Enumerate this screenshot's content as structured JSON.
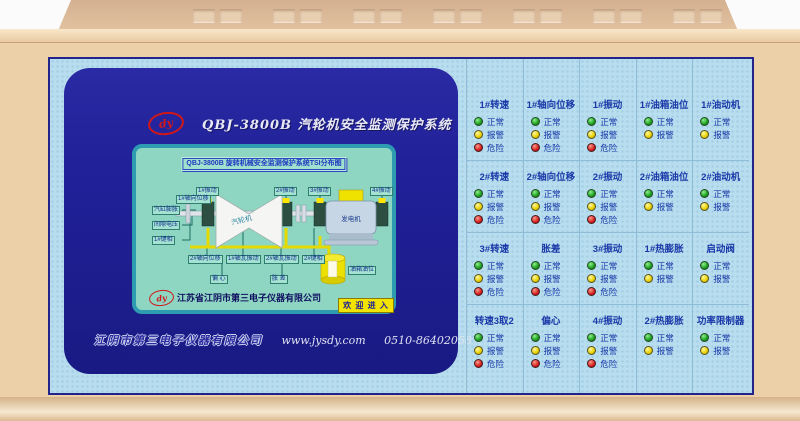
{
  "header": {
    "logo": "dy",
    "title": "QBJ-3800B  汽轮机安全监测保护系统"
  },
  "mimic": {
    "title_bar": "QBJ-3800B 旋转机械安全监测保护系统TSI分布图",
    "top_sensors": [
      "1#振动",
      "2#振动",
      "3#振动",
      "4#振动"
    ],
    "left_sensors": [
      "1#轴向位移",
      "汽缸膨胀",
      "间隙电压",
      "1#键相"
    ],
    "bottom_sensors": [
      "2#轴向位移",
      "1#轴瓦振动",
      "2#轴瓦振动",
      "2#键相"
    ],
    "float_labels": [
      "偏 心",
      "胀 差"
    ],
    "turbine": "汽轮机",
    "generator": "发电机",
    "tank_label": "油箱油位",
    "company": "江苏省江阴市第三电子仪器有限公司",
    "enter_button": "欢 迎 进 入"
  },
  "footer": {
    "company": "江阴市第三电子仪器有限公司",
    "url": "www.jysdy.com",
    "phone": "0510-86402058"
  },
  "indicators": {
    "light_defs": {
      "normal": {
        "label": "正常"
      },
      "alarm": {
        "label": "报警"
      },
      "danger": {
        "label": "危险"
      }
    },
    "cells": [
      {
        "title": "1#转速",
        "lights": [
          "normal",
          "alarm",
          "danger"
        ]
      },
      {
        "title": "1#轴向位移",
        "lights": [
          "normal",
          "alarm",
          "danger"
        ]
      },
      {
        "title": "1#振动",
        "lights": [
          "normal",
          "alarm",
          "danger"
        ]
      },
      {
        "title": "1#油箱油位",
        "lights": [
          "normal",
          "alarm"
        ]
      },
      {
        "title": "1#油动机",
        "lights": [
          "normal",
          "alarm"
        ]
      },
      {
        "title": "2#转速",
        "lights": [
          "normal",
          "alarm",
          "danger"
        ]
      },
      {
        "title": "2#轴向位移",
        "lights": [
          "normal",
          "alarm",
          "danger"
        ]
      },
      {
        "title": "2#振动",
        "lights": [
          "normal",
          "alarm",
          "danger"
        ]
      },
      {
        "title": "2#油箱油位",
        "lights": [
          "normal",
          "alarm"
        ]
      },
      {
        "title": "2#油动机",
        "lights": [
          "normal",
          "alarm"
        ]
      },
      {
        "title": "3#转速",
        "lights": [
          "normal",
          "alarm",
          "danger"
        ]
      },
      {
        "title": "胀差",
        "lights": [
          "normal",
          "alarm",
          "danger"
        ]
      },
      {
        "title": "3#振动",
        "lights": [
          "normal",
          "alarm",
          "danger"
        ]
      },
      {
        "title": "1#热膨胀",
        "lights": [
          "normal",
          "alarm"
        ]
      },
      {
        "title": "启动阀",
        "lights": [
          "normal",
          "alarm"
        ]
      },
      {
        "title": "转速3取2",
        "lights": [
          "normal",
          "alarm",
          "danger"
        ]
      },
      {
        "title": "偏心",
        "lights": [
          "normal",
          "alarm",
          "danger"
        ]
      },
      {
        "title": "4#振动",
        "lights": [
          "normal",
          "alarm",
          "danger"
        ]
      },
      {
        "title": "2#热膨胀",
        "lights": [
          "normal",
          "alarm"
        ]
      },
      {
        "title": "功率限制器",
        "lights": [
          "normal",
          "alarm"
        ]
      }
    ]
  },
  "colors": {
    "beige": "#ecd0a8",
    "beige_dark": "#d3b191",
    "panel_blue": "#b7ddee",
    "navy": "#21219a",
    "lcd_teal": "#8ed5c2",
    "accent_yellow": "#f2e400",
    "logo_red": "#d01818",
    "dot_green": "#1d9e1d",
    "dot_yellow": "#e8cf00",
    "dot_red": "#d42020",
    "label_blue": "#1a38a8"
  }
}
